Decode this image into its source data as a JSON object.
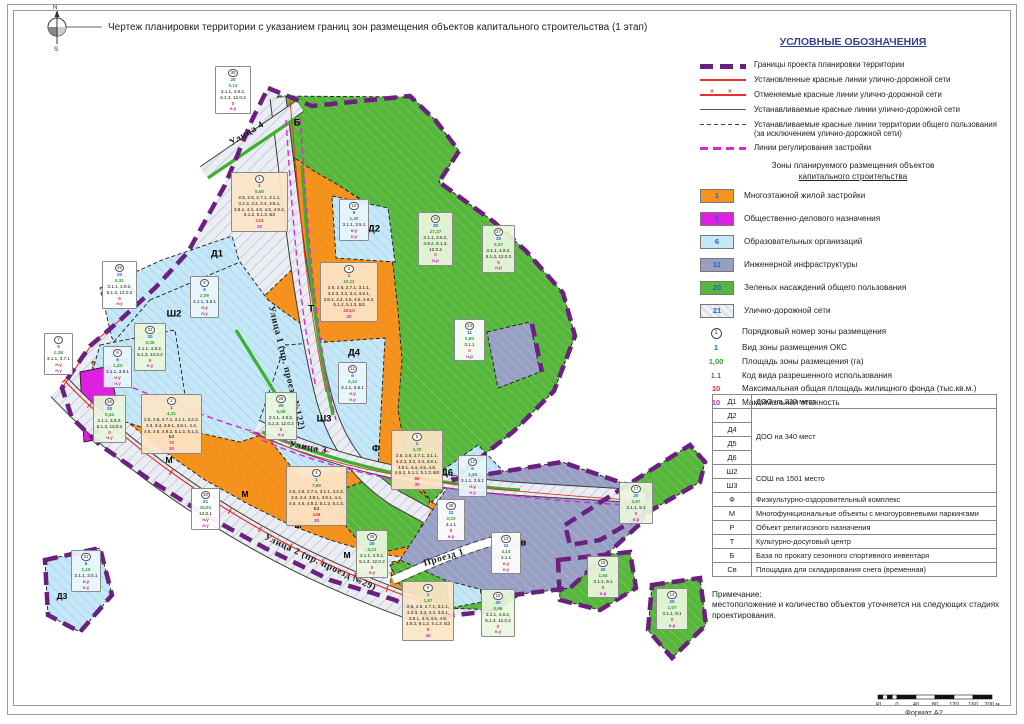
{
  "header": {
    "title": "Чертеж планировки территории с указанием границ зон размещения объектов капитального строительства (1 этап)",
    "compass": {
      "north": "N",
      "south": "S"
    },
    "format_label": "Формат А2"
  },
  "colors": {
    "boundary_purple": "#6B1F7F",
    "red_line": "#E53030",
    "magenta_line": "#D926D9",
    "zone_orange": "#F6921E",
    "zone_magenta": "#E020E0",
    "zone_blue": "#C5E7F8",
    "zone_slate": "#97A0C3",
    "zone_green": "#57B63C",
    "zone_road": "#ECEDF1"
  },
  "legend": {
    "title": "УСЛОВНЫЕ ОБОЗНАЧЕНИЯ",
    "line_items": [
      {
        "style": "s-boundary",
        "label": "Границы проекта планировки территории"
      },
      {
        "style": "s-red-solid",
        "label": "Установленные красные линии улично-дорожной сети"
      },
      {
        "style": "s-red-cross",
        "label": "Отменяемые красные линии улично-дорожной сети"
      },
      {
        "style": "s-dark-solid",
        "label": "Устанавливаемые красные линии улично-дорожной сети"
      },
      {
        "style": "s-black-dash",
        "label": "Устанавливаемые красные линии территории общего пользования (за исключением улично-дорожной сети)"
      },
      {
        "style": "s-magenta-dash",
        "label": "Линии регулирования застройки"
      }
    ],
    "zones_subtitle_1": "Зоны планируемого размещения объектов",
    "zones_subtitle_2": "капитального строительства",
    "zone_items": [
      {
        "num": "1",
        "color": "orange",
        "label": "Многоэтажной жилой застройки"
      },
      {
        "num": "5",
        "color": "magenta",
        "label": "Общественно-делового назначения"
      },
      {
        "num": "6",
        "color": "blue",
        "label": "Образовательных организаций"
      },
      {
        "num": "11",
        "color": "slate",
        "label": "Инженерной инфраструктуры"
      },
      {
        "num": "20",
        "color": "green",
        "label": "Зеленых насаждений общего пользования"
      },
      {
        "num": "21",
        "color": "road",
        "label": "Улично-дорожной сети"
      }
    ],
    "symbol_items": [
      {
        "sym": "1",
        "cls": "circ",
        "label": "Порядковый номер зоны размещения"
      },
      {
        "sym": "1",
        "cls": "c-vid",
        "label": "Вид зоны размещения ОКС"
      },
      {
        "sym": "1,00",
        "cls": "c-area",
        "label": "Площадь зоны размещения (га)"
      },
      {
        "sym": "1.1",
        "cls": "c-code",
        "label": "Код вида разрешенного использования"
      },
      {
        "sym": "10",
        "cls": "c-red",
        "label": "Максимальная общая площадь жилищного фонда (тыс.кв.м.)"
      },
      {
        "sym": "10",
        "cls": "c-mag",
        "label": "Максимальная этажность"
      }
    ]
  },
  "objects_table": {
    "rows": [
      {
        "code": "Д1",
        "desc": "ДОО на 220 мест",
        "span": 1
      },
      {
        "code": "Д2",
        "desc": "ДОО на 340 мест",
        "span": 4
      },
      {
        "code": "Д4"
      },
      {
        "code": "Д5"
      },
      {
        "code": "Д6"
      },
      {
        "code": "Ш2",
        "desc": "СОШ на 1501 место",
        "span": 2
      },
      {
        "code": "Ш3"
      },
      {
        "code": "Ф",
        "desc": "Физкультурно-оздоровительный комплекс",
        "span": 1
      },
      {
        "code": "М",
        "desc": "Многофункциональные объекты с многоуровневыми паркингами",
        "span": 1
      },
      {
        "code": "Р",
        "desc": "Объект религиозного назначения",
        "span": 1
      },
      {
        "code": "Т",
        "desc": "Культурно-досуговый центр",
        "span": 1
      },
      {
        "code": "Б",
        "desc": "База по прокату сезонного спортивного инвентаря",
        "span": 1
      },
      {
        "code": "Св",
        "desc": "Площадка для складирования снега (временная)",
        "span": 1
      }
    ]
  },
  "note": {
    "title": "Примечание:",
    "text": "местоположение и количество объектов уточняется на следующих стадиях проектирования."
  },
  "scalebar": {
    "labels": [
      "40",
      "0",
      "40",
      "80",
      "120",
      "160",
      "200 м"
    ]
  },
  "map": {
    "street_labels": [
      {
        "text": "Улица 4",
        "x": 247,
        "y": 134,
        "angle": -31
      },
      {
        "text": "Улица 1 (пр. проезд №122)",
        "x": 286,
        "y": 368,
        "angle": 76
      },
      {
        "text": "Улица 3",
        "x": 308,
        "y": 448,
        "angle": 10
      },
      {
        "text": "Улица 2 (пр. проезд №29)",
        "x": 320,
        "y": 563,
        "angle": 25
      },
      {
        "text": "Проезд 1",
        "x": 444,
        "y": 558,
        "angle": -17
      }
    ],
    "zone_labels": [
      {
        "text": "Д1",
        "x": 217,
        "y": 254
      },
      {
        "text": "Д2",
        "x": 374,
        "y": 229
      },
      {
        "text": "Д3",
        "x": 62,
        "y": 596,
        "small": true
      },
      {
        "text": "Д4",
        "x": 354,
        "y": 353
      },
      {
        "text": "Д5",
        "x": 123,
        "y": 363
      },
      {
        "text": "Д6",
        "x": 447,
        "y": 473
      },
      {
        "text": "Ш2",
        "x": 174,
        "y": 314
      },
      {
        "text": "Ш3",
        "x": 324,
        "y": 419
      },
      {
        "text": "Ф",
        "x": 376,
        "y": 449
      },
      {
        "text": "Т",
        "x": 311,
        "y": 309
      },
      {
        "text": "Б",
        "x": 297,
        "y": 123
      },
      {
        "text": "Р",
        "x": 117,
        "y": 427,
        "small": true
      },
      {
        "text": "Св",
        "x": 520,
        "y": 543
      },
      {
        "text": "М",
        "x": 96,
        "y": 431,
        "small": true
      },
      {
        "text": "М",
        "x": 169,
        "y": 460,
        "small": true
      },
      {
        "text": "М",
        "x": 245,
        "y": 494,
        "small": true
      },
      {
        "text": "М",
        "x": 298,
        "y": 525,
        "small": true
      },
      {
        "text": "М",
        "x": 347,
        "y": 555,
        "small": true
      }
    ],
    "callouts": [
      {
        "n": "30",
        "vid": "20",
        "area": "0,13",
        "codes": "3.1.1, 4.9.2, 5.1.3, 12.0.2",
        "red": "0",
        "mag": "н.у",
        "x": 215,
        "y": 66,
        "w": 32,
        "bg": "white"
      },
      {
        "n": "25",
        "vid": "20",
        "area": "0,31",
        "codes": "3.1.1, 4.9.2, 5.1.3, 12.0.2",
        "red": "0",
        "mag": "н.у",
        "x": 102,
        "y": 261,
        "w": 31,
        "bg": "white"
      },
      {
        "n": "1",
        "vid": "1",
        "area": "5,50",
        "codes": "2.5, 2.6, 2.7.1, 3.1.1, 3.2.3, 3.3, 3.4, 3.8.1, 3.8.1, 4.4, 4.5, 4.6, 4.9.2, 5.1.2, 5.1.3, БЗ",
        "red": "124",
        "mag": "20",
        "x": 231,
        "y": 172,
        "w": 53,
        "bg": "peach"
      },
      {
        "n": "2",
        "vid": "1",
        "area": "4,31",
        "codes": "2.5, 2.6, 2.7.1, 3.1.1, 3.2.3, 3.3, 3.4, 3.8.1, 3.8.1, 4.4, 4.5, 4.6, 4.9.2, 5.1.2, 5.1.3, БЗ",
        "red": "72",
        "mag": "30",
        "x": 141,
        "y": 394,
        "w": 57,
        "bg": "peach"
      },
      {
        "n": "3",
        "vid": "1",
        "area": "10,11",
        "codes": "2.5, 2.6, 2.7.1, 3.1.1, 3.2.3, 3.3, 3.4, 3.8.1, 3.8.1, 4.4, 4.5, 4.6, 4.9.2, 5.1.2, 5.1.3, БЗ",
        "red": "224,5",
        "mag": "30",
        "x": 320,
        "y": 262,
        "w": 54,
        "bg": "peach"
      },
      {
        "n": "4",
        "vid": "1",
        "area": "7,89",
        "codes": "2.5, 2.6, 2.7.1, 3.1.1, 3.2.3, 3.3, 3.4, 3.8.1, 3.8.1, 4.4, 4.5, 4.6, 4.9.2, 5.1.2, 5.1.3, БЗ",
        "red": "136",
        "mag": "30",
        "x": 286,
        "y": 466,
        "w": 57,
        "bg": "peach"
      },
      {
        "n": "5",
        "vid": "1",
        "area": "3,70",
        "codes": "2.5, 2.6, 2.7.1, 3.1.1, 3.2.3, 3.3, 3.4, 3.8.1, 3.8.1, 4.4, 4.5, 4.6, 4.9.2, 5.1.2, 5.1.3, БЗ",
        "red": "66",
        "mag": "30",
        "x": 391,
        "y": 430,
        "w": 48,
        "bg": "peach"
      },
      {
        "n": "6",
        "vid": "1",
        "area": "1,97",
        "codes": "2.5, 2.6, 2.7.1, 3.1.1, 3.2.3, 3.3, 3.4, 3.8.1, 3.8.1, 4.4, 4.5, 4.6, 4.9.2, 5.1.2, 5.1.3, БЗ",
        "red": "5",
        "mag": "45",
        "x": 402,
        "y": 581,
        "w": 48,
        "bg": "peach"
      },
      {
        "n": "7",
        "vid": "5",
        "area": "0,38",
        "codes": "3.1.1, 3.7.1",
        "red": "н.у",
        "mag": "н.у",
        "x": 44,
        "y": 333,
        "w": 25,
        "bg": "white"
      },
      {
        "n": "8",
        "vid": "6",
        "area": "2,09",
        "codes": "3.1.1, 3.5.1",
        "red": "н.у",
        "mag": "н.у",
        "x": 190,
        "y": 276,
        "w": 25,
        "bg": "blue"
      },
      {
        "n": "9",
        "vid": "6",
        "area": "1,33",
        "codes": "3.1.1, 3.5.1",
        "red": "н.у",
        "mag": "н.у",
        "x": 103,
        "y": 346,
        "w": 25,
        "bg": "blue"
      },
      {
        "n": "10",
        "vid": "6",
        "area": "1,30",
        "codes": "3.1.1, 3.5.1",
        "red": "н.у",
        "mag": "н.у",
        "x": 339,
        "y": 199,
        "w": 26,
        "bg": "blue"
      },
      {
        "n": "11",
        "vid": "6",
        "area": "4,13",
        "codes": "3.1.1, 3.5.1",
        "red": "н.у",
        "mag": "н.у",
        "x": 338,
        "y": 362,
        "w": 25,
        "bg": "blue"
      },
      {
        "n": "12",
        "vid": "6",
        "area": "1,29",
        "codes": "3.1.1, 3.5.1",
        "red": "н.у",
        "mag": "н.у",
        "x": 458,
        "y": 455,
        "w": 25,
        "bg": "blue"
      },
      {
        "n": "13",
        "vid": "11",
        "area": "4,14",
        "codes": "3.1.1",
        "red": "н.у",
        "mag": "н.у",
        "x": 491,
        "y": 532,
        "w": 26,
        "bg": "white"
      },
      {
        "n": "14",
        "vid": "20",
        "area": "1,07",
        "codes": "3.1.1, 9.1",
        "red": "0",
        "mag": "н.р",
        "x": 656,
        "y": 588,
        "w": 28,
        "bg": "green"
      },
      {
        "n": "15",
        "vid": "20",
        "area": "1,54",
        "codes": "3.1.1, 9.1",
        "red": "0",
        "mag": "н.р",
        "x": 587,
        "y": 556,
        "w": 28,
        "bg": "green"
      },
      {
        "n": "16",
        "vid": "20",
        "area": "0,44",
        "codes": "3.1.1, 4.9.2, 5.1.3, 12.0.2",
        "red": "0",
        "mag": "н.у",
        "x": 93,
        "y": 395,
        "w": 29,
        "bg": "green"
      },
      {
        "n": "17",
        "vid": "20",
        "area": "2,67",
        "codes": "3.1.1, 9.1",
        "red": "0",
        "mag": "н.р",
        "x": 619,
        "y": 482,
        "w": 30,
        "bg": "green"
      },
      {
        "n": "18",
        "vid": "20",
        "area": "27,37",
        "codes": "3.1.1, 3.6.2, 4.9.2, 5.1.3, 12.0.2",
        "red": "0",
        "mag": "н.р",
        "x": 418,
        "y": 212,
        "w": 31,
        "bg": "green"
      },
      {
        "n": "19",
        "vid": "20",
        "area": "0,96",
        "codes": "3.1.1, 4.9.2, 5.1.3, 12.0.2",
        "red": "0",
        "mag": "н.у",
        "x": 481,
        "y": 589,
        "w": 30,
        "bg": "green"
      },
      {
        "n": "20",
        "vid": "21",
        "area": "15,81",
        "codes": "12.0.1",
        "red": "н.у",
        "mag": "н.у",
        "x": 191,
        "y": 488,
        "w": 25,
        "bg": "white"
      },
      {
        "n": "22",
        "vid": "20",
        "area": "0,35",
        "codes": "3.1.1, 4.9.2, 5.1.3, 12.0.2",
        "red": "0",
        "mag": "н.у",
        "x": 134,
        "y": 323,
        "w": 28,
        "bg": "green"
      },
      {
        "n": "24",
        "vid": "11",
        "area": "0,60",
        "codes": "3.1.1",
        "red": "0",
        "mag": "н.р",
        "x": 454,
        "y": 319,
        "w": 27,
        "bg": "white"
      },
      {
        "n": "26",
        "vid": "20",
        "area": "0,06",
        "codes": "3.1.1, 4.9.2, 5.1.3, 12.0.2",
        "red": "0",
        "mag": "н.у",
        "x": 265,
        "y": 392,
        "w": 28,
        "bg": "green"
      },
      {
        "n": "27",
        "vid": "20",
        "area": "0,37",
        "codes": "3.1.1, 4.9.2, 5.1.3, 12.0.2",
        "red": "0",
        "mag": "н.р",
        "x": 482,
        "y": 225,
        "w": 29,
        "bg": "green"
      },
      {
        "n": "28",
        "vid": "20",
        "area": "0,12",
        "codes": "3.1.1, 4.9.2, 5.1.3, 12.0.2",
        "red": "0",
        "mag": "н.у",
        "x": 356,
        "y": 530,
        "w": 28,
        "bg": "green"
      },
      {
        "n": "29",
        "vid": "11",
        "area": "0,23",
        "codes": "3.1.1",
        "red": "0",
        "mag": "н.р",
        "x": 437,
        "y": 499,
        "w": 24,
        "bg": "white"
      },
      {
        "n": "31",
        "vid": "6",
        "area": "1,10",
        "codes": "3.1.1, 3.5.1",
        "red": "н.у",
        "mag": "н.у",
        "x": 71,
        "y": 550,
        "w": 26,
        "bg": "blue"
      }
    ]
  }
}
